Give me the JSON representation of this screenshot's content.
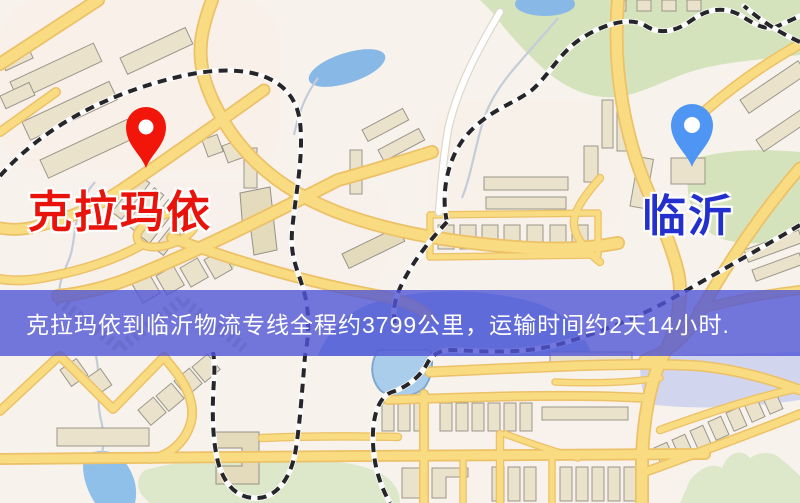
{
  "map": {
    "origin": {
      "name": "克拉玛依"
    },
    "destination": {
      "name": "临沂"
    },
    "banner": {
      "text": "克拉玛依到临沂物流专线全程约3799公里，运输时间约2天14小时."
    }
  },
  "colors": {
    "background": "#f7f3ec",
    "road": "#f9dc82",
    "road_casing": "#ecc167",
    "park": "#d5e3bd",
    "water": "#9fc2ec",
    "building": "#eae2cb",
    "railway": "#26262a",
    "origin_pin": "#f2150a",
    "origin_label": "#e8130a",
    "destination_pin": "#4f95f3",
    "destination_label": "#2430cd",
    "banner_bg": "rgba(80,85,214,0.8)",
    "banner_text": "#ffffff"
  }
}
